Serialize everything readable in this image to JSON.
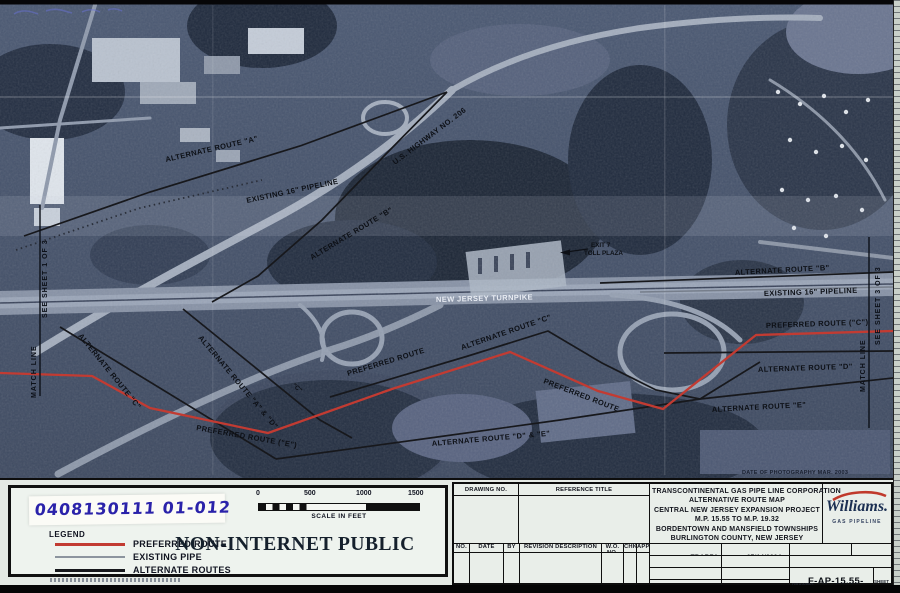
{
  "map": {
    "labels": {
      "alt_a": "ALTERNATE ROUTE \"A\"",
      "existing_left": "EXISTING 16\" PIPELINE",
      "us_hwy": "U.S. HIGHWAY NO. 206",
      "alt_b_left": "ALTERNATE ROUTE \"B\"",
      "exit7_line1": "EXIT 7",
      "exit7_line2": "TOLL PLAZA",
      "turnpike": "NEW JERSEY TURNPIKE",
      "alt_b_right": "ALTERNATE ROUTE \"B\"",
      "existing_right": "EXISTING 16\" PIPELINE",
      "pref_c": "PREFERRED ROUTE (\"C\")",
      "alt_d": "ALTERNATE ROUTE \"D\"",
      "alt_e": "ALTERNATE ROUTE \"E\"",
      "alt_c_mid": "ALTERNATE ROUTE \"C\"",
      "pref_1": "PREFERRED ROUTE",
      "pref_2": "PREFERRED ROUTE",
      "alt_c_left": "ALTERNATE ROUTE \"C\"",
      "alt_ad": "ALTERNATE ROUTE \"A\" & \"D\"",
      "pref_e": "PREFERRED ROUTE (\"E\")",
      "alt_de": "ALTERNATE ROUTE \"D\" & \"E\"",
      "c_small": "\"C\"",
      "match_left_line": "MATCH LINE",
      "match_left_sheet": "SEE SHEET 1 OF 3",
      "match_right_line": "MATCH LINE",
      "match_right_sheet": "SEE SHEET 3 OF 3",
      "photo_date": "DATE OF PHOTOGRAPHY MAR. 2003"
    },
    "colors": {
      "preferred_route": "#C23B32",
      "existing_pipe": "#8C949E",
      "alternate_route": "#17181C"
    }
  },
  "footer": {
    "handwritten_id": "0408130111 01-012",
    "legend": {
      "title": "LEGEND",
      "items": [
        {
          "label": "PREFERRED ROUTE",
          "color": "#C23B32"
        },
        {
          "label": "EXISTING PIPE",
          "color": "#8C949E"
        },
        {
          "label": "ALTERNATE ROUTES",
          "color": "#17181C"
        }
      ]
    },
    "scale_bar": {
      "ticks": [
        "0",
        "500",
        "1000",
        "1500"
      ],
      "caption": "SCALE IN FEET"
    },
    "classification": "NON-INTERNET PUBLIC",
    "title_block": {
      "drawing_no_header": "DRAWING NO.",
      "reference_title_header": "REFERENCE TITLE",
      "company_lines": [
        "TRANSCONTINENTAL GAS PIPE LINE CORPORATION",
        "ALTERNATIVE ROUTE MAP",
        "CENTRAL NEW JERSEY EXPANSION PROJECT",
        "M.P. 15.55 TO M.P. 19.32",
        "BORDENTOWN AND MANSFIELD TOWNSHIPS",
        "BURLINGTON COUNTY, NEW JERSEY"
      ],
      "logo": {
        "name": "Williams.",
        "sub": "GAS PIPELINE"
      },
      "revision_headers": [
        "NO.",
        "DATE",
        "BY",
        "REVISION DESCRIPTION",
        "W.O. NO.",
        "CHK",
        "APP"
      ],
      "fields": {
        "drawn_by_label": "DRAWN BY:",
        "drawn_by": "TBARZA",
        "date1_label": "DATE:",
        "date1": "07/14/2004",
        "issued_bid": "ISSUED FOR BID",
        "scale_label": "SCALE:",
        "scale": "SHOWN",
        "checked_by_label": "CHECKED BY:",
        "date2_label": "DATE:",
        "issued_construction": "ISSUED FOR CONSTRUCTION",
        "approved_by_label": "APPROVED BY:",
        "date3_label": "DATE:",
        "drawing_number_label1": "DRAWING",
        "drawing_number_label2": "NUMBER",
        "drawing_number": "F-AP-15.55-ALT",
        "pn_label": "PN:",
        "pn": "40993",
        "unix_label": "UNIX ID:",
        "unix": "TBWOR",
        "sheet_label": "SHEET",
        "sheet_no": "2",
        "of_label": "OF",
        "of_no": "3"
      }
    }
  }
}
